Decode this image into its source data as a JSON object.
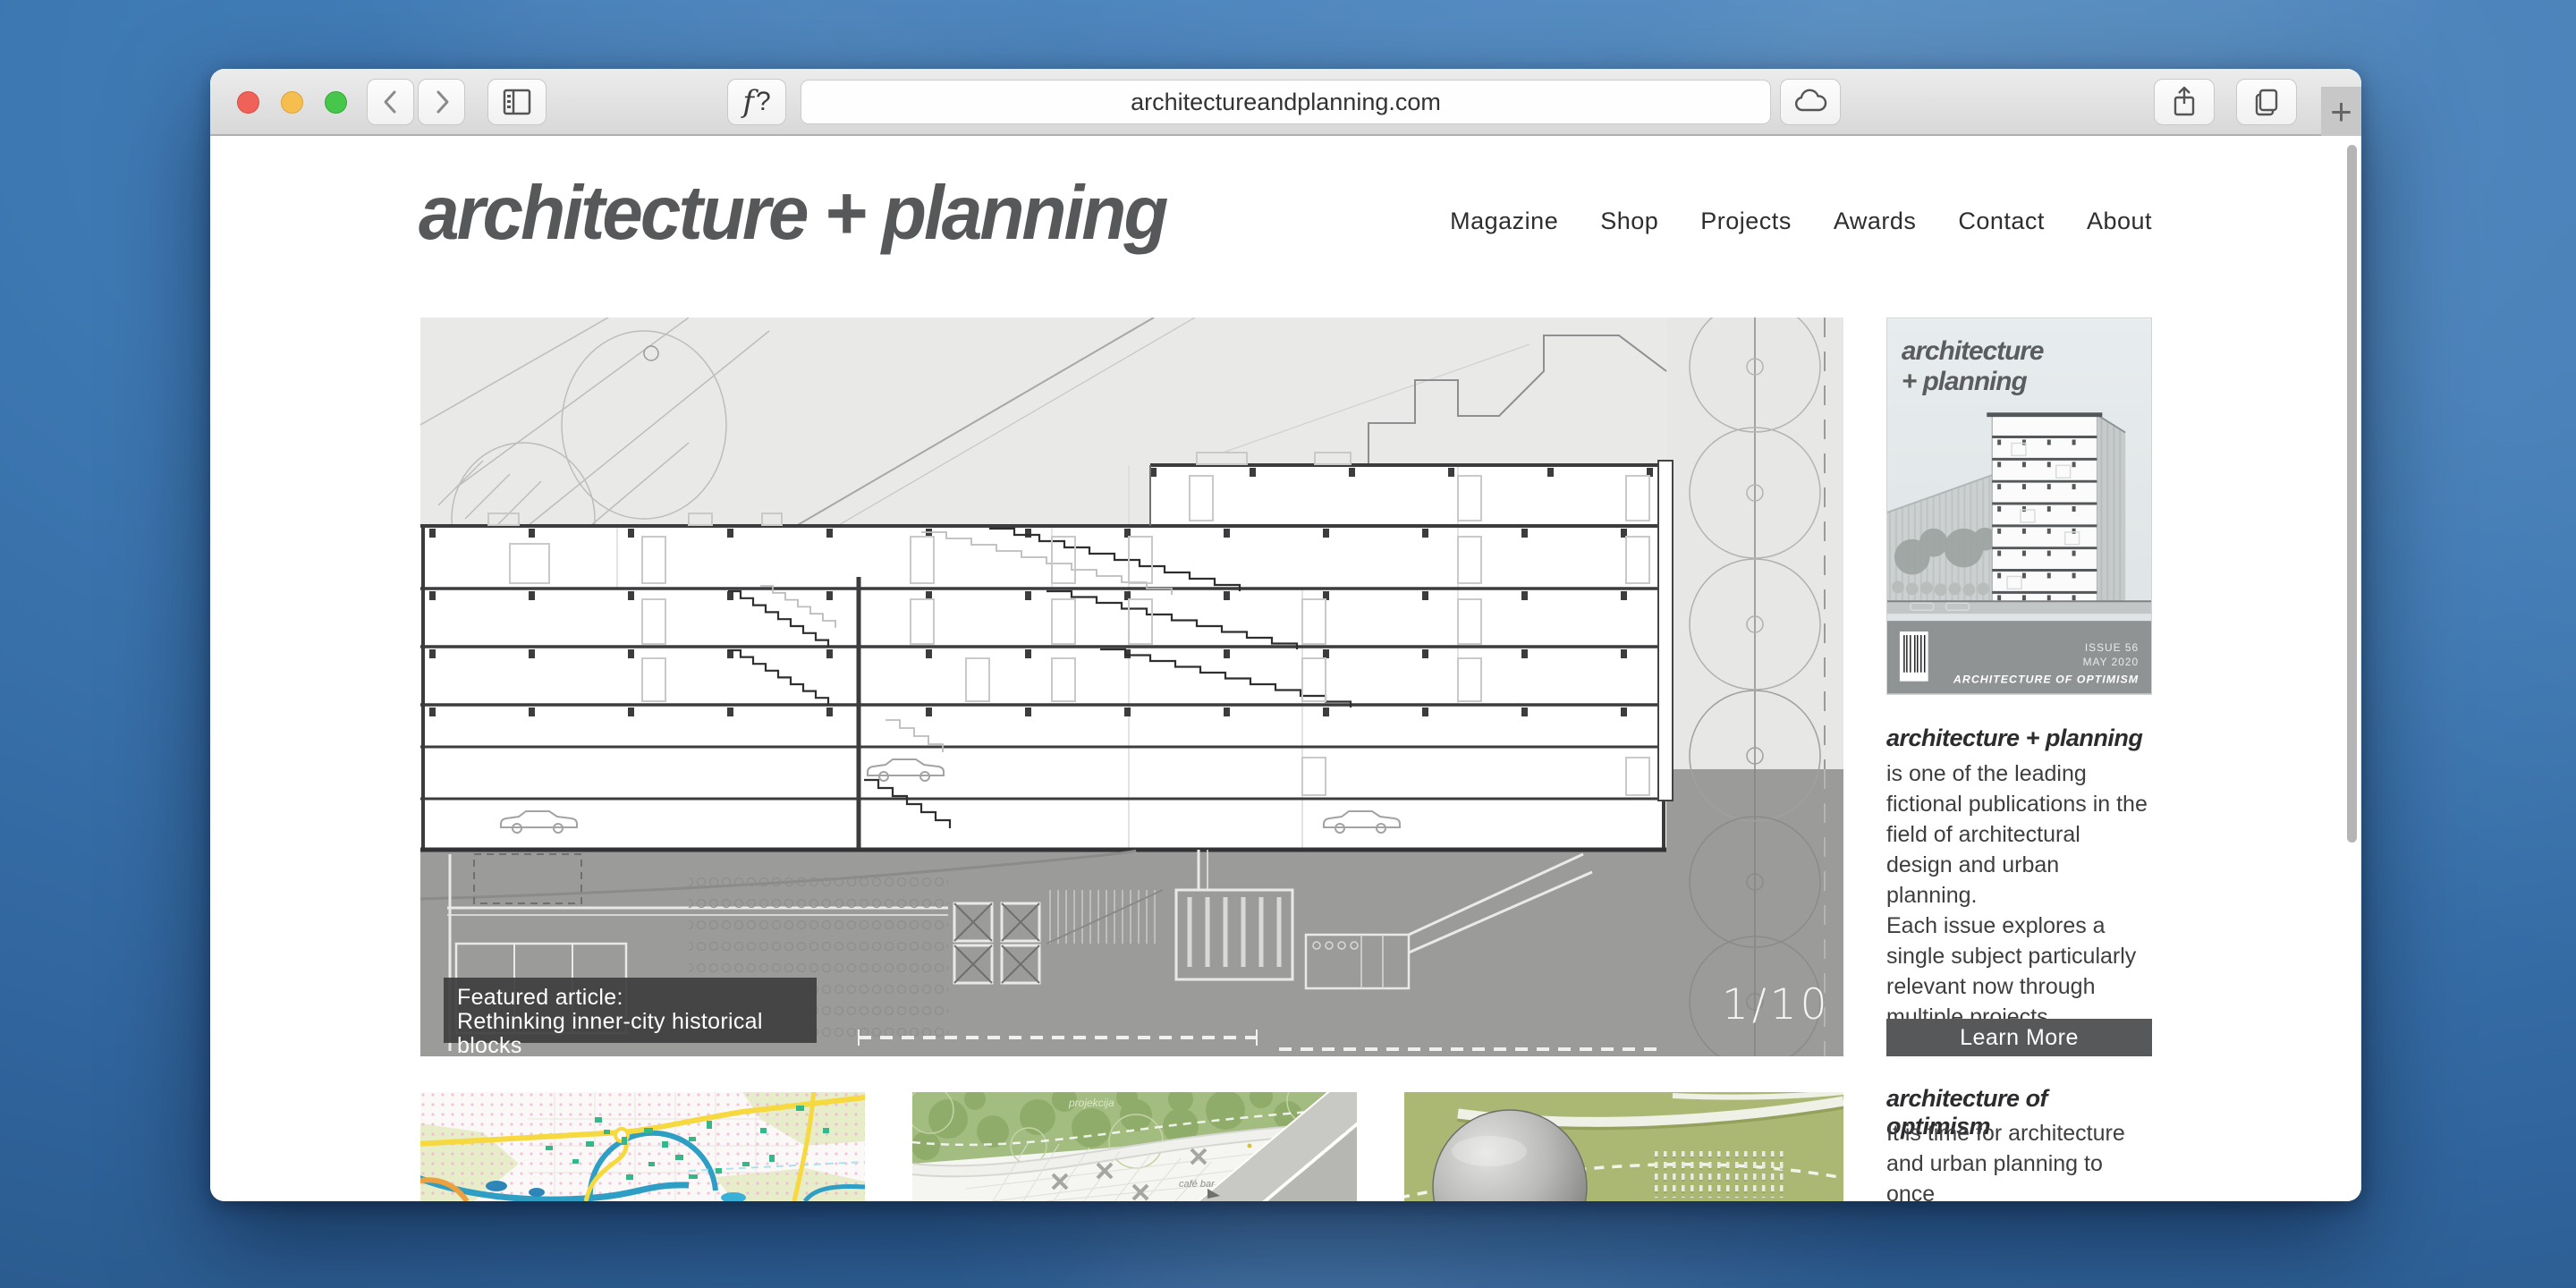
{
  "browser": {
    "url": "architectureandplanning.com",
    "page_icon_label": "f?",
    "new_tab_label": "+",
    "window_controls": [
      "close",
      "minimize",
      "zoom"
    ],
    "toolbar_icons": [
      "back-chevron",
      "forward-chevron",
      "sidebar-toggle",
      "cloud",
      "share",
      "tabs-overview",
      "new-tab-plus"
    ]
  },
  "site": {
    "logo": "architecture + planning",
    "nav": [
      "Magazine",
      "Shop",
      "Projects",
      "Awards",
      "Contact",
      "About"
    ],
    "featured": {
      "caption_line1": "Featured article:",
      "caption_line2": "Rethinking inner-city historical blocks",
      "counter": "1/10"
    },
    "sidebar": {
      "cover": {
        "logo_line1": "architecture",
        "logo_line2": "+ planning",
        "issue": "ISSUE 56",
        "date": "MAY 2020",
        "theme": "ARCHITECTURE OF OPTIMISM"
      },
      "about_heading": "architecture + planning",
      "about_text": "is one of the leading\nfictional publications in the\nfield of architectural\ndesign and urban planning.\nEach issue explores a\nsingle subject particularly\nrelevant now through\nmultiple projects.",
      "learn_more_label": "Learn More",
      "feature_heading": "architecture of optimism",
      "feature_text": "It is time for architecture\nand urban planning to once\nagain adopt confident hope"
    },
    "thumbs": {
      "thumb2_label_1": "projekcija",
      "thumb2_label_2": "café bar"
    }
  },
  "colors": {
    "desktop_blue": "#3e79b3",
    "accent_dark_gray": "#57585a",
    "caption_bg": "#3e3e40",
    "drawing_gray_band": "#9b9b99",
    "map_yellow": "#f6d83f",
    "map_teal": "#35b789",
    "map_river_blue": "#2e9ec5",
    "park_green": "#a3bc80",
    "olive_green": "#abb873"
  }
}
